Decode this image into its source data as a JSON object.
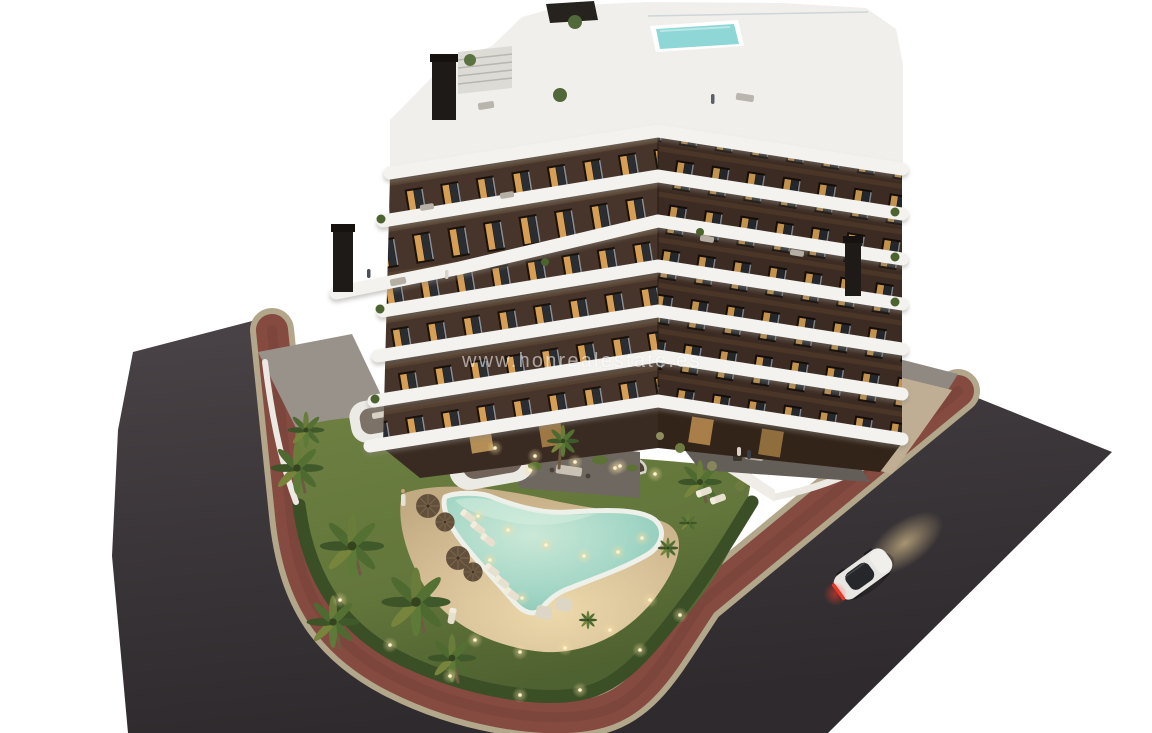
{
  "scene": {
    "kind": "architectural-render-aerial-dusk",
    "watermark": {
      "text": "www.honrealestate.es",
      "color": "#ffffff",
      "opacity": 0.55
    }
  },
  "palette": {
    "background": "#ffffff",
    "asphalt": "#3b3639",
    "asphalt_light": "#4a4347",
    "sidewalk_red": "#854a40",
    "curb": "#b2a68b",
    "lawn": "#63763b",
    "hedge": "#3a4f26",
    "sand": "#d7c098",
    "pool_water": "#a3d6c6",
    "pool_coping": "#eef0ea",
    "facade_left": "#47342a",
    "facade_right": "#3c2b22",
    "balcony_white": "#f3f2ee",
    "window_dark": "#191009",
    "window_lit": "#d9a158",
    "rooftop_pool": "#8fd6d6",
    "chimney": "#1e1a17",
    "patio": "#6e6861",
    "plaza": "#96908a",
    "path_beige": "#bfae94",
    "wall_white": "#efece7",
    "palm_green": "#4e6a31",
    "palm_lit": "#76843c",
    "trunk": "#6e5b44",
    "car_body": "#e8e6e2",
    "car_glass": "#25272a",
    "taillight": "#e03726",
    "light_warm": "#f5dfa8"
  },
  "objects": {
    "building": "seven-storey apartment block, dark brown facade, white curved balcony bands",
    "rooftop": "roof terrace with plunge pool, pergola and staircase",
    "garden": "lawn with free-form swimming pool, sun loungers, parasols and palm trees",
    "roads": "dark asphalt road with red brick sidewalk wrapping the plot",
    "car": "white coupe with tail lights lit",
    "lighting": "dusk scene with warm interior and garden lights"
  }
}
